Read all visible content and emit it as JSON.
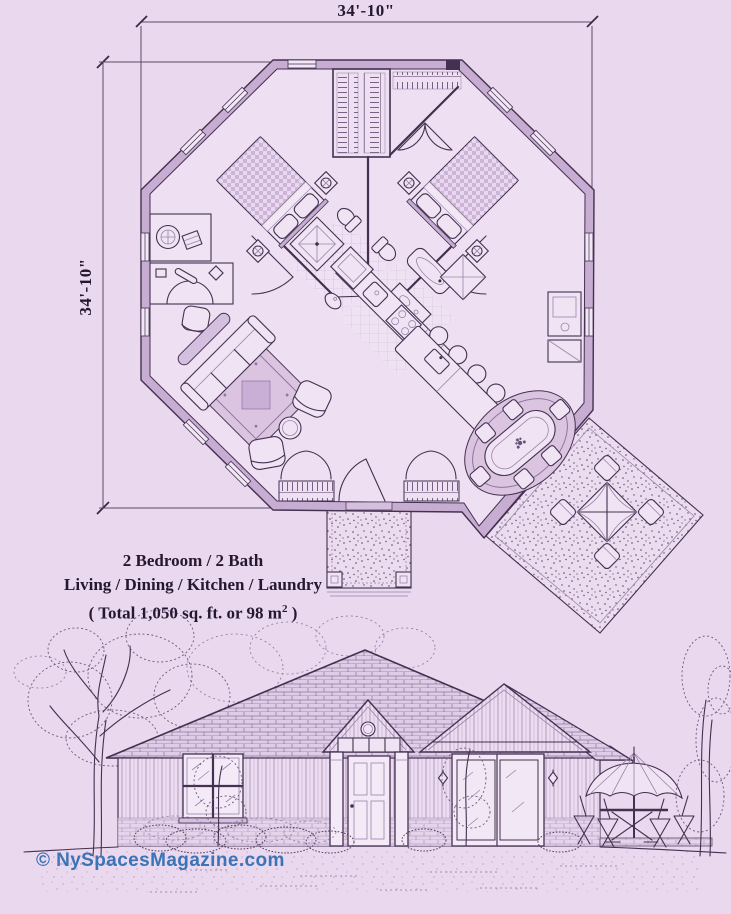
{
  "canvas": {
    "width": 731,
    "height": 914,
    "background": "#e9d8ee",
    "ink": "#443050",
    "wall_fill": "#c8add3"
  },
  "dimension_labels": {
    "top": "34'-10\"",
    "left": "34'-10\""
  },
  "plan_summary": {
    "line1": "2 Bedroom / 2 Bath",
    "line2": "Living / Dining / Kitchen / Laundry",
    "line3_prefix": "( Total 1,050 sq. ft. or 98 m",
    "line3_sup": "2",
    "line3_suffix": " )"
  },
  "watermark": {
    "text": "© NySpacesMagazine.com",
    "color": "#2d6cb3"
  },
  "icons": {
    "bed-icon": "checkered-spread-rectangle",
    "washer-icon": "circle-in-square",
    "stove-icon": "four-burner-circles",
    "umbrella-icon": "x-cross-canopy-square",
    "porch-light-icon": "diamond-lantern",
    "shower-icon": "square-with-x"
  }
}
